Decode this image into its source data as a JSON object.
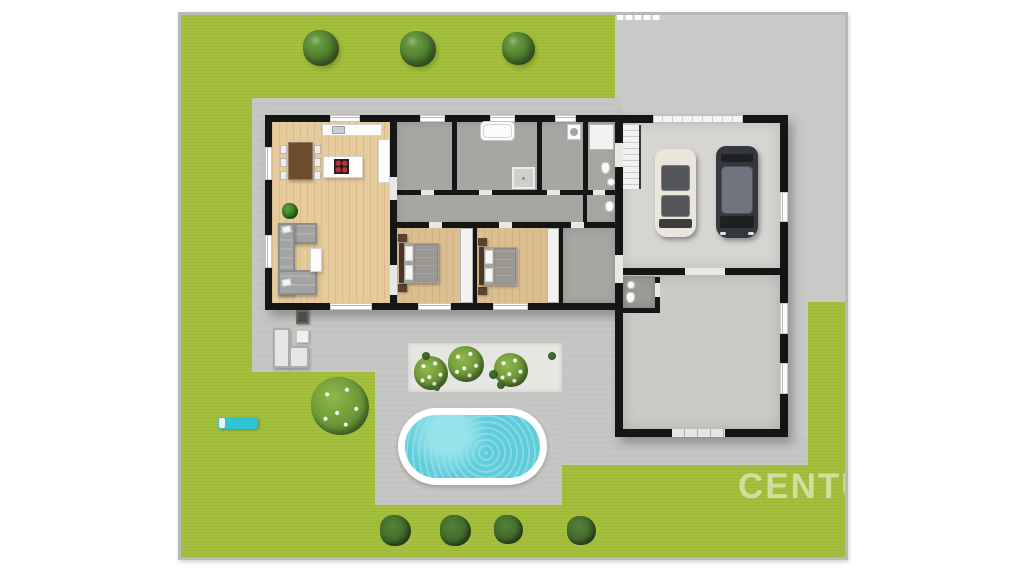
{
  "scene": {
    "description": "3D top-down floor plan rendering of a single-storey house with garage wing, garden, driveway and swimming pool",
    "watermark_text": "CENTU"
  },
  "palette": {
    "page_bg": "#ffffff",
    "frame": "#b7babb",
    "lawn": "#a4bf3b",
    "driveway": "#c9c9c7",
    "patio": "#c4c4c2",
    "gravel": "#e6e6e2",
    "pool_rim": "#ffffff",
    "pool_water": "#5fccdb",
    "pool_water_light": "#96e3ec",
    "wall": "#151515",
    "wood": "#e6cb9c",
    "wood_dark": "#dcbf90",
    "room_gray": "#a7a6a2",
    "room_dark": "#9a9a96",
    "garage_floor": "#d6d5d1",
    "lower_floor": "#cbcac6",
    "closet": "#f2f2f0",
    "fixture_white": "#fbfbfa",
    "sofa_gray": "#a3a3a1",
    "table_brown": "#6f4b2e",
    "lounger_cyan": "#2fc4d6",
    "car_white": "#eae6db",
    "car_dark": "#34373b",
    "glass_dark": "#55565a",
    "glass_blue": "#70747e",
    "watermark": "rgba(255,255,255,0.5)"
  },
  "vegetation": {
    "trees": [
      {
        "x": 140,
        "y": 33,
        "s": 36
      },
      {
        "x": 237,
        "y": 34,
        "s": 36
      },
      {
        "x": 337,
        "y": 33,
        "s": 33
      }
    ],
    "bottom_bushes": [
      {
        "x": 214,
        "y": 515,
        "s": 31
      },
      {
        "x": 274,
        "y": 515,
        "s": 31
      },
      {
        "x": 327,
        "y": 514,
        "s": 29
      },
      {
        "x": 400,
        "y": 515,
        "s": 29
      }
    ],
    "garden_bushes": [
      {
        "x": 250,
        "y": 358,
        "s": 34
      },
      {
        "x": 285,
        "y": 349,
        "s": 36
      },
      {
        "x": 330,
        "y": 355,
        "s": 34
      }
    ],
    "dot_bushes": [
      {
        "x": 245,
        "y": 341,
        "s": 8
      },
      {
        "x": 371,
        "y": 341,
        "s": 8
      },
      {
        "x": 312,
        "y": 359,
        "s": 9
      },
      {
        "x": 320,
        "y": 370,
        "s": 8
      },
      {
        "x": 256,
        "y": 373,
        "s": 6
      }
    ],
    "flower_bushes": [
      {
        "x": 159,
        "y": 391,
        "s": 58
      }
    ]
  }
}
